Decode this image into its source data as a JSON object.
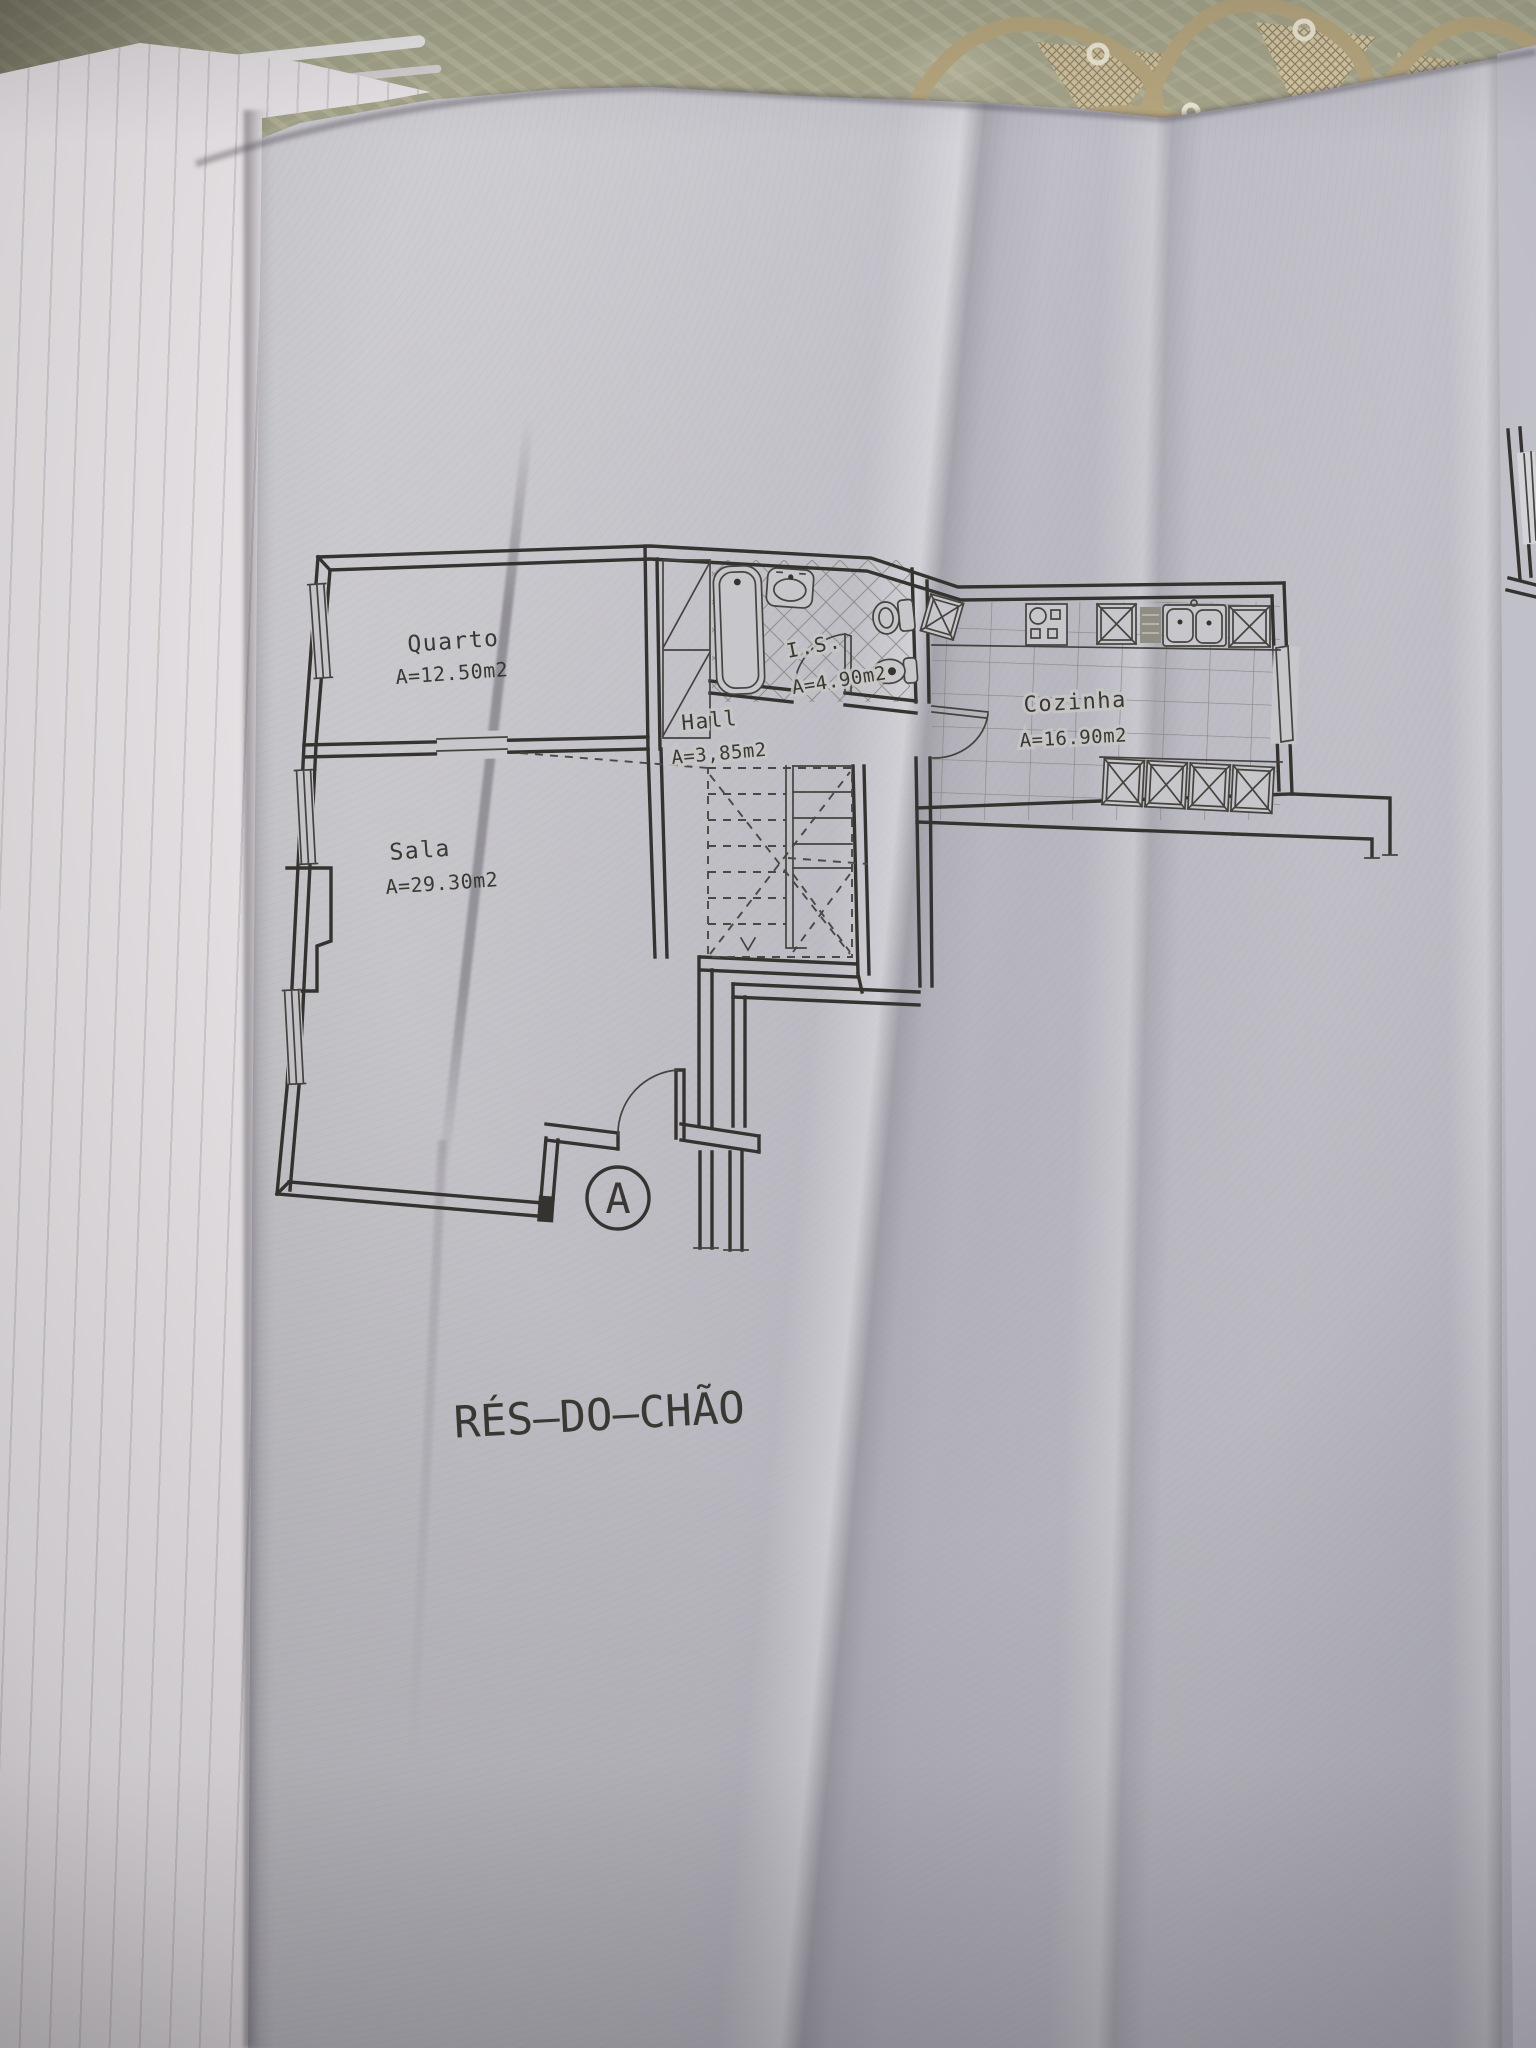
{
  "photo": {
    "floor_title": "RÉS–DO–CHÃO",
    "section_marker": "A"
  },
  "rooms": [
    {
      "name": "Quarto",
      "area": "A=12.50m2"
    },
    {
      "name": "Sala",
      "area": "A=29.30m2"
    },
    {
      "name": "Hall",
      "area": "A=3,85m2"
    },
    {
      "name": "I.S.",
      "area": "A=4.90m2"
    },
    {
      "name": "Cozinha",
      "area": "A=16.90m2"
    }
  ],
  "colors": {
    "paper": "#c6c5ca",
    "ink": "#35332f",
    "tablecloth": "#a5a48a",
    "doily_thread": "#b7a77f",
    "page_stack": "#e9e5e8"
  }
}
